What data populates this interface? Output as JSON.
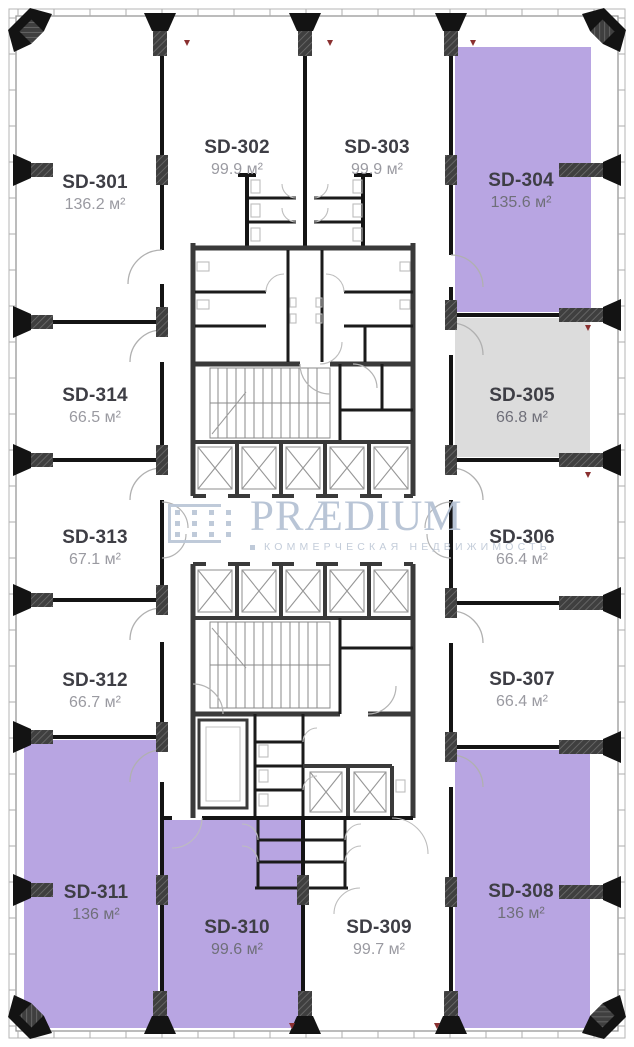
{
  "watermark": {
    "brand": "PRÆDIUM",
    "tagline": "КОММЕРЧЕСКАЯ НЕДВИЖИМОСТЬ",
    "color": "#b6c2d4"
  },
  "colors": {
    "unit_available": "#b8a5e2",
    "unit_reserved": "#dcdcdc",
    "unit_default": "#ffffff",
    "wall": "#141414",
    "core_wall": "#3a3a3a",
    "unit_name_text": "#3e3e45",
    "unit_area_text": "#9a9aa1",
    "unit_area_text_on_fill": "#6f6f79"
  },
  "units": [
    {
      "id": "SD-301",
      "area": "136.2 м²",
      "fill": "#ffffff"
    },
    {
      "id": "SD-302",
      "area": "99.9 м²",
      "fill": "#ffffff"
    },
    {
      "id": "SD-303",
      "area": "99.9 м²",
      "fill": "#ffffff"
    },
    {
      "id": "SD-304",
      "area": "135.6 м²",
      "fill": "#b8a5e2"
    },
    {
      "id": "SD-305",
      "area": "66.8 м²",
      "fill": "#dcdcdc"
    },
    {
      "id": "SD-306",
      "area": "66.4 м²",
      "fill": "#ffffff"
    },
    {
      "id": "SD-307",
      "area": "66.4 м²",
      "fill": "#ffffff"
    },
    {
      "id": "SD-308",
      "area": "136 м²",
      "fill": "#b8a5e2"
    },
    {
      "id": "SD-309",
      "area": "99.7 м²",
      "fill": "#ffffff"
    },
    {
      "id": "SD-310",
      "area": "99.6 м²",
      "fill": "#b8a5e2"
    },
    {
      "id": "SD-311",
      "area": "136 м²",
      "fill": "#b8a5e2"
    },
    {
      "id": "SD-312",
      "area": "66.7 м²",
      "fill": "#ffffff"
    },
    {
      "id": "SD-313",
      "area": "67.1 м²",
      "fill": "#ffffff"
    },
    {
      "id": "SD-314",
      "area": "66.5 м²",
      "fill": "#ffffff"
    }
  ]
}
